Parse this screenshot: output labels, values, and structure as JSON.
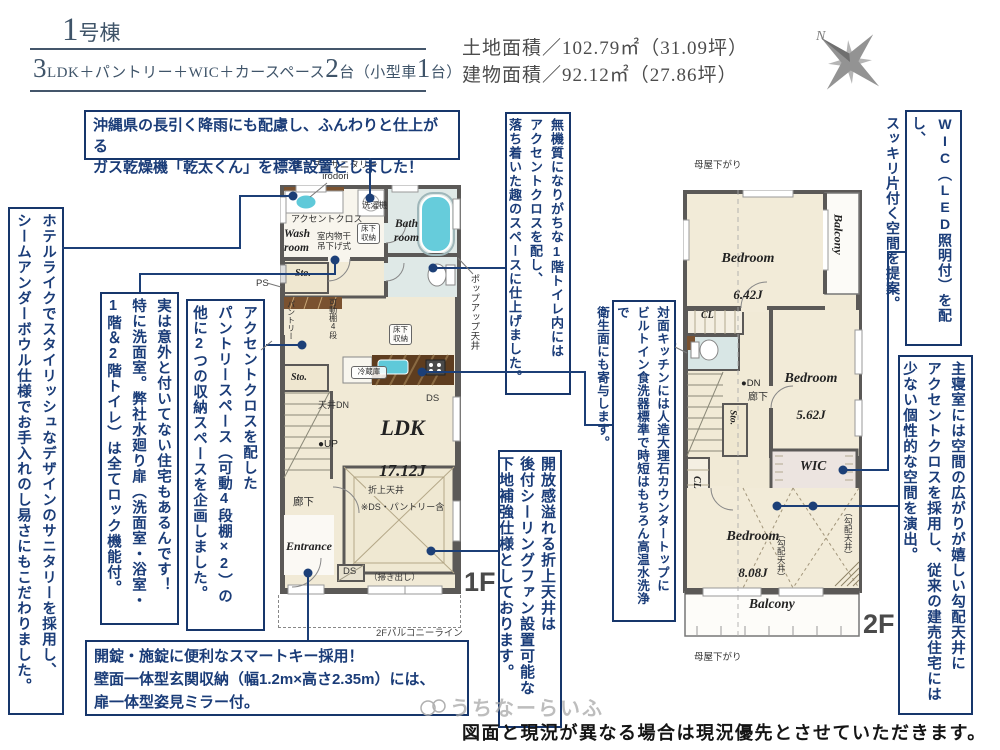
{
  "header": {
    "building_no": "1",
    "building_suffix": "号棟",
    "spec": {
      "n1": "3",
      "t1": "LDK＋パントリー＋WIC＋カースペース",
      "n2": "2",
      "t2": "台（小型車",
      "n3": "1",
      "t3": "台）"
    },
    "land_area": "土地面積／102.79㎡（31.09坪）",
    "building_area": "建物面積／92.12㎡（27.86坪）",
    "compass_n": "N"
  },
  "notes": {
    "dryer": "沖縄県の長引く降雨にも配慮し、ふんわりと仕上がる\nガス乾燥機「乾太くん」を標準設置としました！",
    "sanitary": "ホテルライクでスタイリッシュなデザインのサニタリーを採用し、\nシームアンダーボウル仕様でお手入れのし易さにもこだわりました。",
    "lock": "実は意外と付いてない住宅もあるんです！\n特に洗面室。弊社水廻り扉（洗面室・浴室・\n1階＆2階トイレ）は全てロック機能付。",
    "pantry": "アクセントクロスを配した\nパントリースペース（可動4段棚×2）の\n他に2つの収納スペースを企画しました。",
    "toilet": "無機質になりがちな1階トイレ内には\nアクセントクロスを配し、\n落ち着いた趣のスペースに仕上げました。",
    "kitchen": "対面キッチンには人造大理石カウンタートップに\nビルトイン食洗器標準で時短はもちろん高温水洗浄で\n衛生面にも寄与します。",
    "ceiling": "開放感溢れる折上天井は\n後付シーリングファン設置可能な\n下地補強仕様としております。",
    "entry": "開錠・施錠に便利なスマートキー採用！\n壁面一体型玄関収納（幅1.2m×高さ2.35m）には、\n扉一体型姿見ミラー付。",
    "wic": "WIC（LED照明付）を配し、\nスッキリ片付く空間を提案。",
    "master": "主寝室には空間の広がりが嬉しい勾配天井に\nアクセントクロスを採用し、従来の建売住宅には\n少ない個性的な空間を演出。"
  },
  "plan1f": {
    "floor_label": "1F",
    "open_sanitary": "オープンサニタリー\nirodori",
    "washer": "洗濯機",
    "accent_cloth": "アクセントクロス",
    "accent_cloth_side": "アクセントクロス",
    "wash_room": "Wash\nroom",
    "bath_room": "Bath\nroom",
    "indoor_drying": "室内物干\n吊下げ式",
    "underfloor1": "床下収納",
    "sto1": "Sto.",
    "sto2": "Sto.",
    "ps": "PS",
    "pantry": "パントリー",
    "shelf": "可動棚4段",
    "fridge": "冷蔵庫",
    "underfloor2": "床下収納",
    "popup_ceiling": "ポップアップ天井",
    "ceiling_dn": "天井DN",
    "up": "●UP",
    "ldk": "LDK",
    "ldk_size": "17.12J",
    "ldk_note": "※DS・パントリー含",
    "ds1": "DS",
    "orikami": "折上天井",
    "hallway": "廊下",
    "entrance": "Entrance",
    "ds2": "DS",
    "hakidashi": "（掃き出し）",
    "balcony_line": "2Fバルコニーライン"
  },
  "plan2f": {
    "floor_label": "2F",
    "moya_top": "母屋下がり",
    "moya_bottom": "母屋下がり",
    "bedroom1": "Bedroom",
    "bedroom1_size": "6.42J",
    "balcony_top": "Balcony",
    "cl1": "CL",
    "counter": "カウンター",
    "dn": "●DN",
    "hallway": "廊下",
    "sto": "Sto.",
    "bedroom2": "Bedroom",
    "bedroom2_size": "5.62J",
    "wic": "WIC",
    "cl2": "CL",
    "bedroom3": "Bedroom",
    "bedroom3_size": "8.08J",
    "sloped1": "（勾配天井）",
    "sloped2": "（勾配天井）",
    "balcony_bottom": "Balcony"
  },
  "footer": {
    "watermark": "うちなーらいふ",
    "disclaimer": "図面と現況が異なる場合は現況優先とさせていただきます。"
  },
  "colors": {
    "accent_navy": "#17366b",
    "wall_gray": "#5b5957",
    "floor_cream": "#f1ead6",
    "water_blue": "#dfe9e7",
    "fixture_cyan": "#5fc9d9",
    "wood_brown": "#7a5230"
  }
}
